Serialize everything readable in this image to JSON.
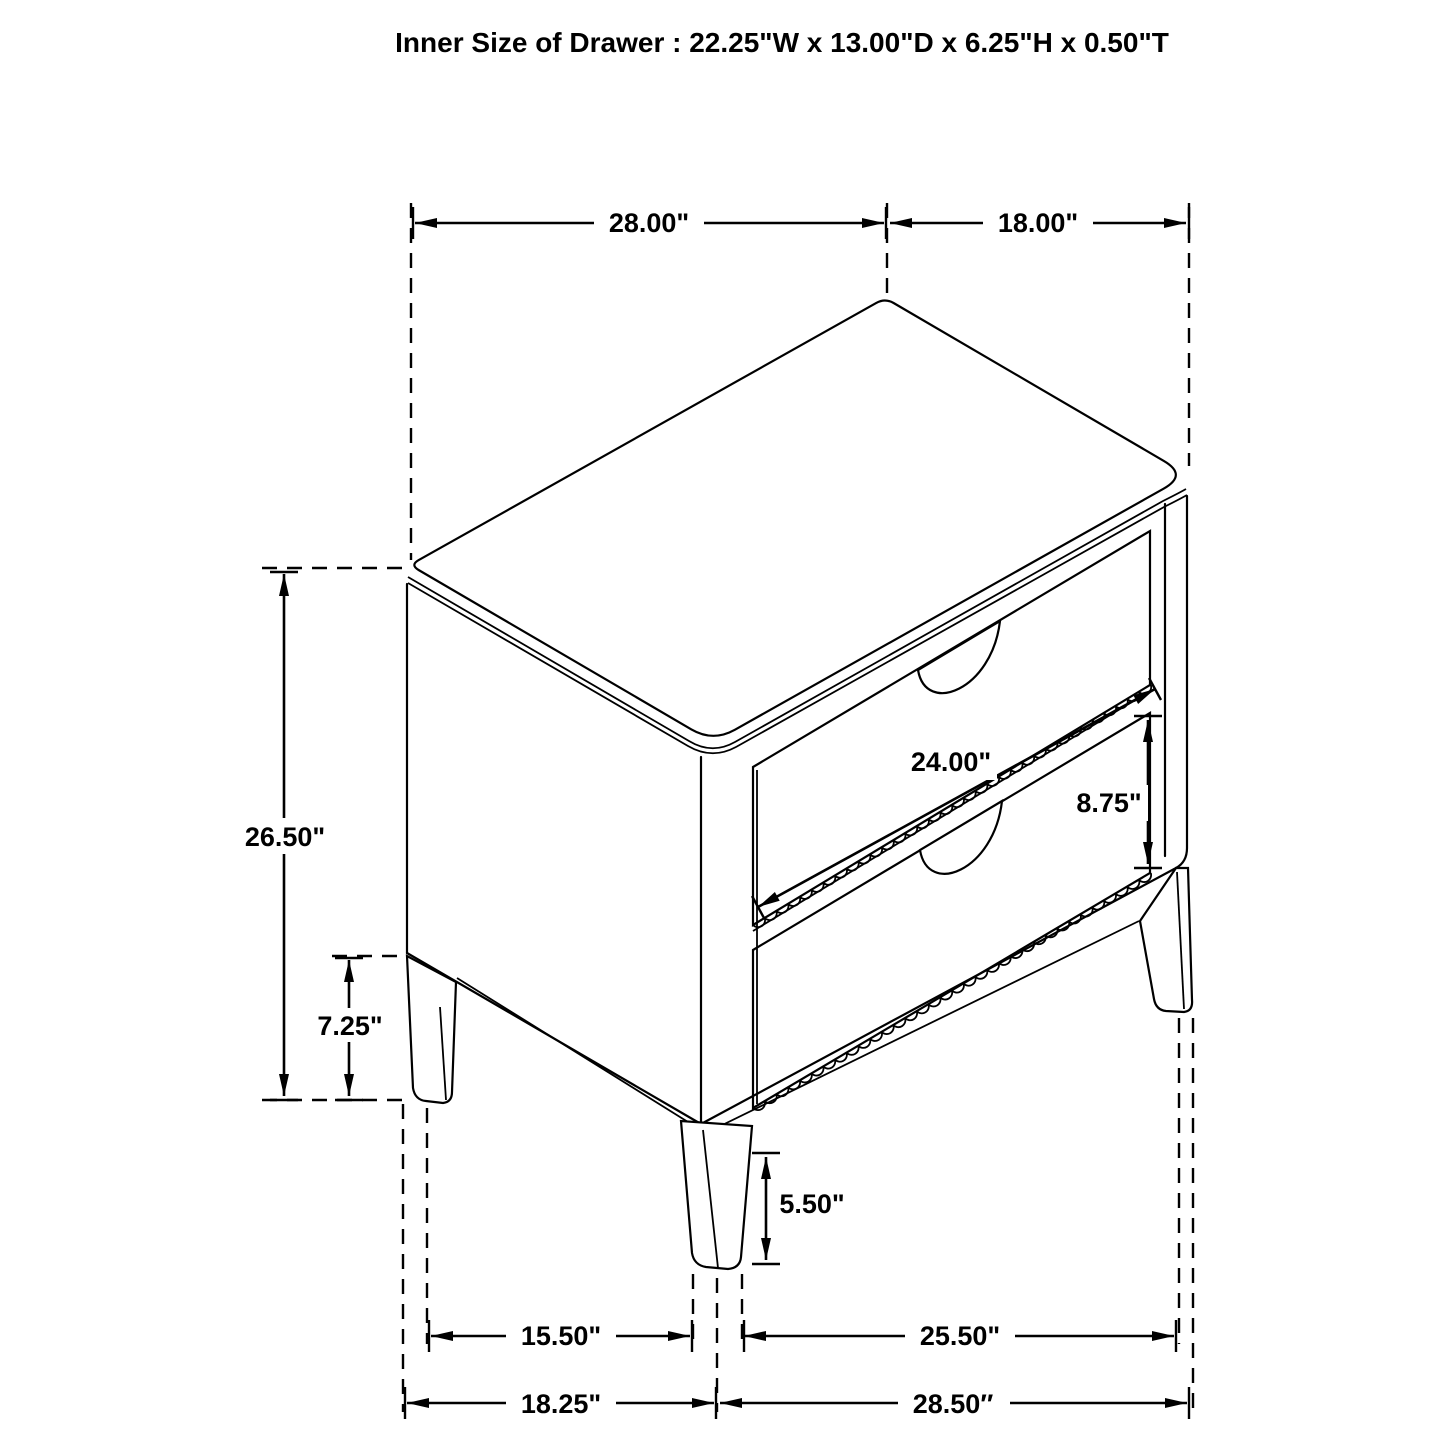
{
  "title": "Inner Size of Drawer : 22.25\"W x 13.00\"D x 6.25\"H x 0.50\"T",
  "dims": {
    "top_width": "28.00\"",
    "top_depth": "18.00\"",
    "overall_height": "26.50\"",
    "side_clearance_height": "7.25\"",
    "drawer_front_width": "24.00\"",
    "drawer_front_height": "8.75\"",
    "leg_height": "5.50\"",
    "front_leg_spacing": "15.50\"",
    "side_leg_spacing": "25.50\"",
    "base_width": "18.25\"",
    "base_depth": "28.50″"
  },
  "colors": {
    "line": "#000000",
    "text": "#000000",
    "background": "#ffffff"
  }
}
